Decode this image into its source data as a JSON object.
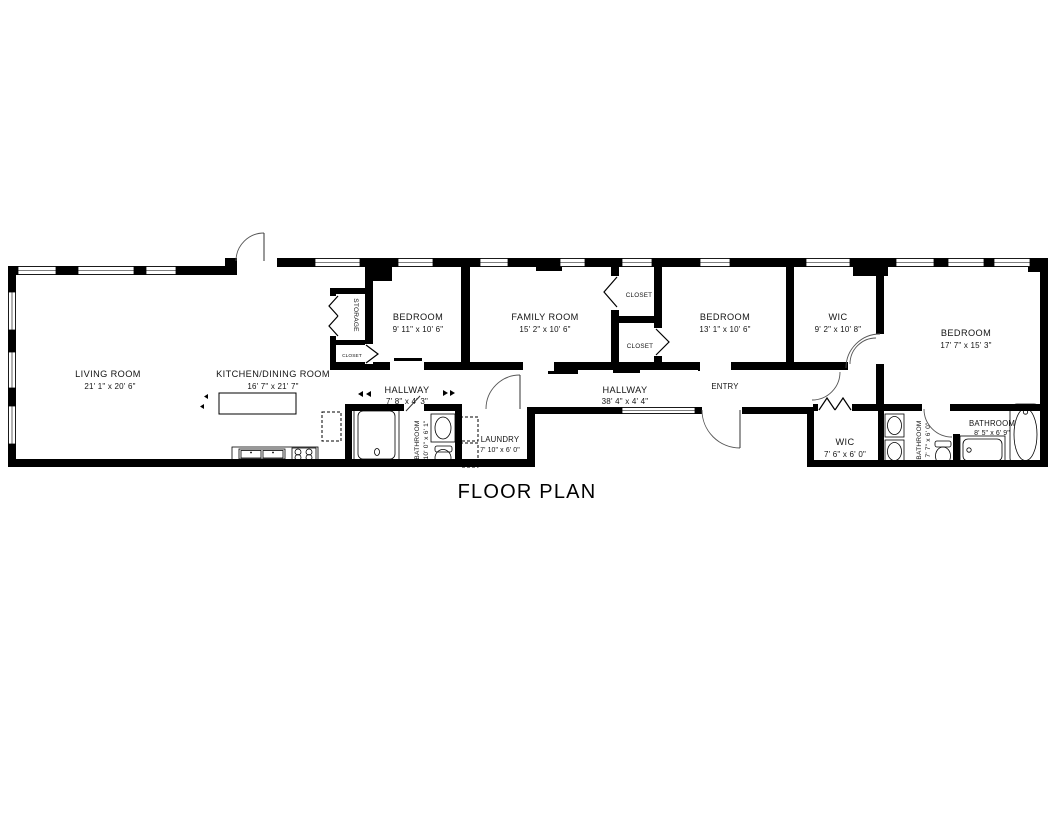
{
  "title": "FLOOR PLAN",
  "colors": {
    "wall": "#000000",
    "background": "#ffffff",
    "text": "#141414"
  },
  "rooms": {
    "living_room": {
      "name": "LIVING ROOM",
      "dims": "21' 1\" x 20' 6\""
    },
    "kitchen_dining": {
      "name": "KITCHEN/DINING ROOM",
      "dims": "16' 7\" x 21' 7\""
    },
    "storage": {
      "name": "STORAGE"
    },
    "storage_closet": {
      "name": "CLOSET"
    },
    "bedroom_1": {
      "name": "BEDROOM",
      "dims": "9' 11\" x 10' 6\""
    },
    "family_room": {
      "name": "FAMILY ROOM",
      "dims": "15' 2\" x 10' 6\""
    },
    "closet_top": {
      "name": "CLOSET"
    },
    "closet_bottom": {
      "name": "CLOSET"
    },
    "bedroom_2": {
      "name": "BEDROOM",
      "dims": "13' 1\" x 10' 6\""
    },
    "wic_1": {
      "name": "WIC",
      "dims": "9' 2\" x 10' 8\""
    },
    "bedroom_3": {
      "name": "BEDROOM",
      "dims": "17' 7\" x 15' 3\""
    },
    "hallway_1": {
      "name": "HALLWAY",
      "dims": "7' 8\" x 4' 3\""
    },
    "hallway_2": {
      "name": "HALLWAY",
      "dims": "38' 4\" x 4' 4\""
    },
    "entry": {
      "name": "ENTRY"
    },
    "bathroom_1": {
      "name": "BATHROOM",
      "dims": "10' 0\" x 6' 1\""
    },
    "laundry": {
      "name": "LAUNDRY",
      "dims": "7' 10\" x 6' 0\""
    },
    "wic_2": {
      "name": "WIC",
      "dims": "7' 6\" x 6' 0\""
    },
    "bathroom_2": {
      "name": "BATHROOM",
      "dims": "7' 7\" x 6' 0\""
    },
    "bathroom_3": {
      "name": "BATHROOM",
      "dims": "8' 5\" x 6' 9\""
    }
  }
}
